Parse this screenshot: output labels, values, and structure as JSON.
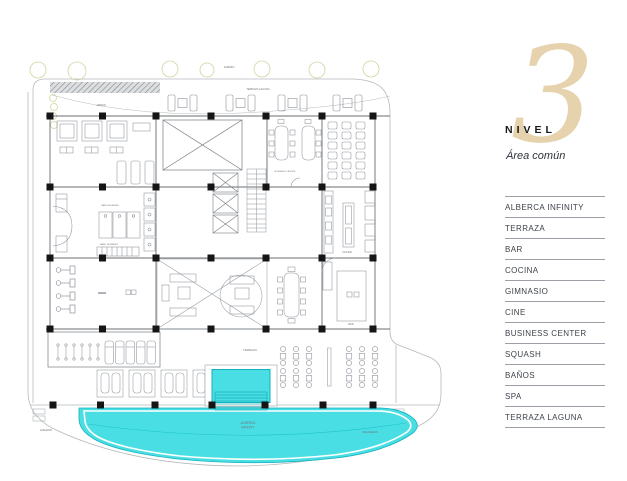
{
  "panel": {
    "level_number": "3",
    "level_label": "NIVEL",
    "area_label": "Área común",
    "amenities": [
      "ALBERCA INFINITY",
      "TERRAZA",
      "BAR",
      "COCINA",
      "GIMNASIO",
      "CINE",
      "BUSINESS CENTER",
      "SQUASH",
      "BAÑOS",
      "SPA",
      "TERRAZA LAGUNA"
    ]
  },
  "plan": {
    "labels": {
      "jardin_top": "JARDIN",
      "jardin_left": "JARDIN",
      "terraza_laguna": "TERRAZA LAGUNA",
      "terraza": "TERRAZA",
      "alberca_line1": "ALBERCA",
      "alberca_line2": "INFINITY",
      "cocina": "COCINA",
      "bar": "BAR",
      "business_center": "BUSINESS CENTER",
      "bano_mujeres": "BAÑO MUJERES",
      "bano_hombres": "BAÑO HOMBRES",
      "andador": "ANDADOR",
      "regaderas": "REGADERAS"
    },
    "colors": {
      "pool": "#49dee3",
      "pool_edge": "#12b2bd",
      "tree": "#cdd6a0",
      "column": "#151515"
    }
  },
  "colors": {
    "accent_beige": "#e6d3ae",
    "text_dark": "#16181b",
    "rule_gray": "#9aa0a5"
  }
}
